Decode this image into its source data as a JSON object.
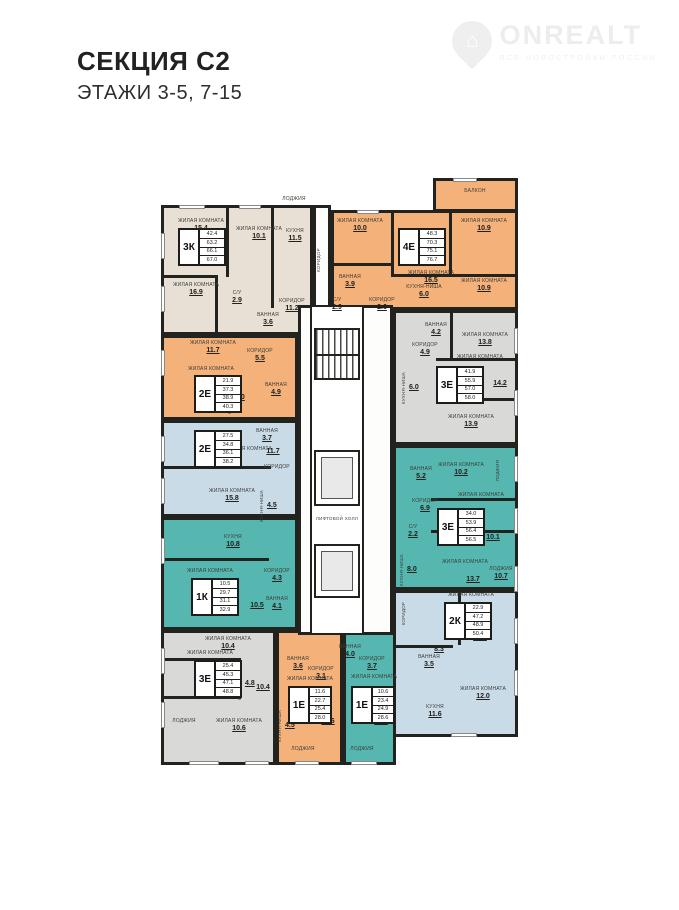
{
  "header": {
    "title": "СЕКЦИЯ С2",
    "subtitle": "ЭТАЖИ 3-5, 7-15"
  },
  "watermark": {
    "brand": "ONREALT",
    "tagline": "ВСЕ НОВОСТРОЙКИ РОССИИ",
    "house_glyph": "⌂"
  },
  "core": {
    "lift_hall": "ЛИФТОВОЙ ХОЛЛ",
    "corridor": "КОРИДОР"
  },
  "colors": {
    "beige": "#e8e0d4",
    "orange": "#f4b179",
    "blue": "#cadbe8",
    "teal": "#56b7b0",
    "gray": "#d9d9d8",
    "wall": "#22221e"
  },
  "units": [
    {
      "id": "3k",
      "type": "3К",
      "table": [
        "42.4",
        "63.2",
        "66.1",
        "67.0"
      ],
      "rooms": [
        {
          "name": "ЖИЛАЯ КОМНАТА",
          "area": "15.4"
        },
        {
          "name": "ЖИЛАЯ КОМНАТА",
          "area": "10.1"
        },
        {
          "name": "КУХНЯ",
          "area": "11.5"
        },
        {
          "name": "ЖИЛАЯ КОМНАТА",
          "area": "16.9"
        },
        {
          "name": "КОРИДОР",
          "area": "11.2"
        },
        {
          "name": "С/У",
          "area": "2.9"
        },
        {
          "name": "ВАННАЯ",
          "area": "3.6"
        },
        {
          "name": "ЛОДЖИЯ",
          "area": ""
        }
      ]
    },
    {
      "id": "4e",
      "type": "4Е",
      "table": [
        "48.3",
        "70.3",
        "75.1",
        "76.7"
      ],
      "rooms": [
        {
          "name": "БАЛКОН",
          "area": ""
        },
        {
          "name": "ЖИЛАЯ КОМНАТА",
          "area": "10.0"
        },
        {
          "name": "ЖИЛАЯ КОМНАТА",
          "area": "16.5"
        },
        {
          "name": "ЖИЛАЯ КОМНАТА",
          "area": "10.9"
        },
        {
          "name": "ЖИЛАЯ КОМНАТА",
          "area": "10.9"
        },
        {
          "name": "КУХНЯ-НИША",
          "area": "6.0"
        },
        {
          "name": "ВАННАЯ",
          "area": "3.9"
        },
        {
          "name": "С/У",
          "area": "2.9"
        },
        {
          "name": "КОРИДОР",
          "area": "2.6"
        }
      ]
    },
    {
      "id": "2e-orange",
      "type": "2Е",
      "table": [
        "21.9",
        "37.3",
        "38.9",
        "40.3"
      ],
      "rooms": [
        {
          "name": "ЖИЛАЯ КОМНАТА",
          "area": "11.7"
        },
        {
          "name": "КОРИДОР",
          "area": "5.5"
        },
        {
          "name": "ЖИЛАЯ КОМНАТА",
          "area": "10.2"
        },
        {
          "name": "КУХНЯ-НИША",
          "area": "5.0"
        },
        {
          "name": "ВАННАЯ",
          "area": "4.9"
        }
      ]
    },
    {
      "id": "2e-blue",
      "type": "2Е",
      "table": [
        "27.5",
        "34.8",
        "36.1",
        "38.2"
      ],
      "rooms": [
        {
          "name": "ЖИЛАЯ КОМНАТА",
          "area": "11.7"
        },
        {
          "name": "ВАННАЯ",
          "area": "3.7"
        },
        {
          "name": "КОРИДОР",
          "area": ""
        },
        {
          "name": "ЖИЛАЯ КОМНАТА",
          "area": "15.8"
        },
        {
          "name": "КУХНЯ-НИША",
          "area": "4.5"
        }
      ]
    },
    {
      "id": "1k",
      "type": "1К",
      "table": [
        "10.5",
        "29.7",
        "31.1",
        "32.9"
      ],
      "rooms": [
        {
          "name": "КУХНЯ",
          "area": "10.8"
        },
        {
          "name": "ЖИЛАЯ КОМНАТА",
          "area": "10.5"
        },
        {
          "name": "КОРИДОР",
          "area": "4.3"
        },
        {
          "name": "ВАННАЯ",
          "area": "4.1"
        }
      ]
    },
    {
      "id": "3e-gray-bl",
      "type": "3Е",
      "table": [
        "25.4",
        "45.3",
        "47.1",
        "48.8"
      ],
      "rooms": [
        {
          "name": "ЖИЛАЯ КОМНАТА",
          "area": "10.4"
        },
        {
          "name": "ЖИЛАЯ КОМНАТА",
          "area": "10.4"
        },
        {
          "name": "КУХНЯ-НИША",
          "area": "4.8"
        },
        {
          "name": "ЖИЛАЯ КОМНАТА",
          "area": "10.6"
        },
        {
          "name": "ЛОДЖИЯ",
          "area": ""
        }
      ]
    },
    {
      "id": "1e-orange",
      "type": "1Е",
      "table": [
        "11.6",
        "22.7",
        "25.4",
        "28.0"
      ],
      "rooms": [
        {
          "name": "ВАННАЯ",
          "area": "3.6"
        },
        {
          "name": "КОРИДОР",
          "area": "3.1"
        },
        {
          "name": "КУХНЯ-НИША",
          "area": "4.5"
        },
        {
          "name": "ЖИЛАЯ КОМНАТА",
          "area": "11.6"
        },
        {
          "name": "ЛОДЖИЯ",
          "area": ""
        }
      ]
    },
    {
      "id": "1e-teal",
      "type": "1Е",
      "table": [
        "10.6",
        "23.4",
        "24.9",
        "28.6"
      ],
      "rooms": [
        {
          "name": "ВАННАЯ",
          "area": "4.0"
        },
        {
          "name": "КОРИДОР",
          "area": "3.7"
        },
        {
          "name": "ЖИЛАЯ КОМНАТА",
          "area": "10.6"
        },
        {
          "name": "ЛОДЖИЯ",
          "area": ""
        }
      ]
    },
    {
      "id": "2k",
      "type": "2К",
      "table": [
        "22.9",
        "47.2",
        "48.9",
        "50.4"
      ],
      "rooms": [
        {
          "name": "КОРИДОР",
          "area": "8.3"
        },
        {
          "name": "ВАННАЯ",
          "area": "3.5"
        },
        {
          "name": "ЖИЛАЯ КОМНАТА",
          "area": "10.9"
        },
        {
          "name": "ЖИЛАЯ КОМНАТА",
          "area": "12.0"
        },
        {
          "name": "КУХНЯ",
          "area": "11.6"
        }
      ]
    },
    {
      "id": "3e-teal",
      "type": "3Е",
      "table": [
        "34.0",
        "53.9",
        "56.4",
        "56.5"
      ],
      "rooms": [
        {
          "name": "ВАННАЯ",
          "area": "5.2"
        },
        {
          "name": "ЖИЛАЯ КОМНАТА",
          "area": "10.2"
        },
        {
          "name": "ЛОДЖИЯ",
          "area": ""
        },
        {
          "name": "КОРИДОР",
          "area": "6.9"
        },
        {
          "name": "ЖИЛАЯ КОМНАТА",
          "area": "10.1"
        },
        {
          "name": "С/У",
          "area": "2.2"
        },
        {
          "name": "КУХНЯ-НИША",
          "area": "8.0"
        },
        {
          "name": "ЖИЛАЯ КОМНАТА",
          "area": "13.7"
        },
        {
          "name": "ЛОДЖИЯ",
          "area": "10.7"
        }
      ]
    },
    {
      "id": "3e-gray-r",
      "type": "3Е",
      "table": [
        "41.9",
        "55.9",
        "57.0",
        "58.0"
      ],
      "rooms": [
        {
          "name": "ВАННАЯ",
          "area": "4.2"
        },
        {
          "name": "КОРИДОР",
          "area": "4.9"
        },
        {
          "name": "ЖИЛАЯ КОМНАТА",
          "area": "13.8"
        },
        {
          "name": "ЖИЛАЯ КОМНАТА",
          "area": "14.2"
        },
        {
          "name": "КУХНЯ-НИША",
          "area": "6.0"
        },
        {
          "name": "ЖИЛАЯ КОМНАТА",
          "area": "13.9"
        }
      ]
    }
  ]
}
